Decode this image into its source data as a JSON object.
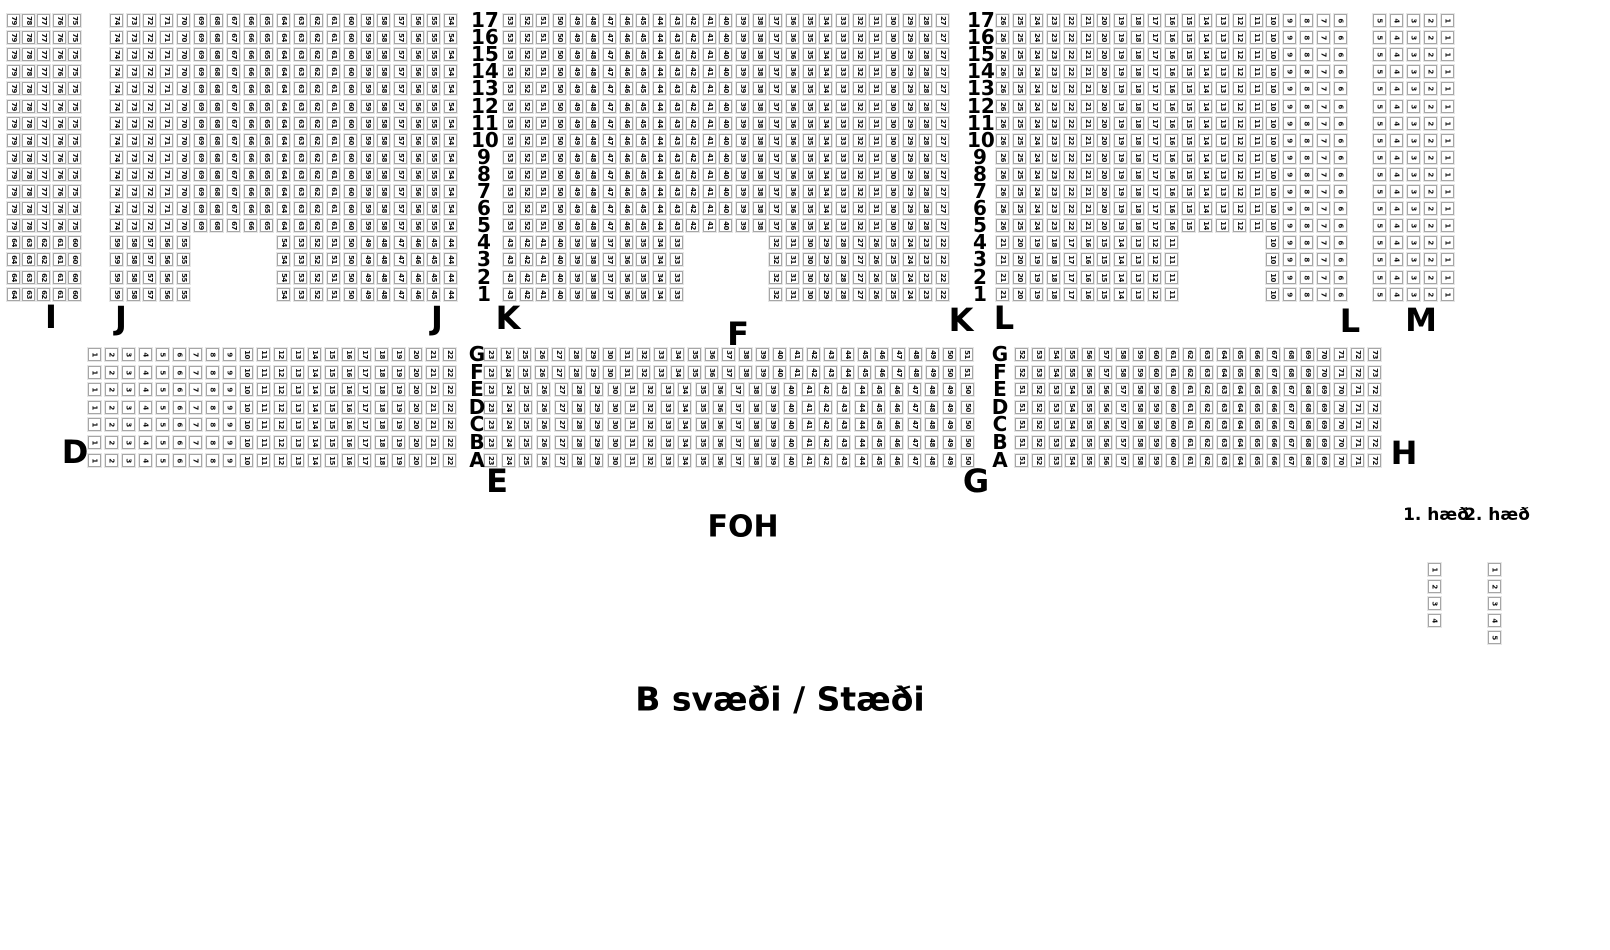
{
  "labels": {
    "section_i": "I",
    "section_j": "J",
    "section_k": "K",
    "section_l": "L",
    "section_m": "M",
    "section_d": "D",
    "section_e": "E",
    "section_f": "F",
    "section_g": "G",
    "section_h": "H",
    "foh": "FOH",
    "area_title": "B svæði / Stæði",
    "floor_1": "1. hæð",
    "floor_2": "2. hæð"
  },
  "colors": {
    "background": "#ffffff",
    "seat_fill": "#ffffff",
    "seat_border": "#a6a6a6",
    "text": "#000000"
  },
  "seatmap": {
    "seat_size": 13,
    "blocks": [
      {
        "name": "rear-block",
        "y0": 14,
        "row_pitch": 17.1,
        "row_labels": [
          "17",
          "16",
          "15",
          "14",
          "13",
          "12",
          "11",
          "10",
          "9",
          "8",
          "7",
          "6",
          "5",
          "4",
          "3",
          "2",
          "1"
        ],
        "label_cols": [
          {
            "x": 471
          },
          {
            "x": 967
          }
        ],
        "sections": [
          {
            "name": "I",
            "x": 7,
            "pitch": 15.2,
            "groups": [
              {
                "rows": [
                  0,
                  12
                ],
                "runs": [
                  {
                    "c0": 0,
                    "from": 79,
                    "to": 75
                  }
                ]
              },
              {
                "rows": [
                  13,
                  16
                ],
                "runs": [
                  {
                    "c0": 0,
                    "from": 64,
                    "to": 60
                  }
                ]
              }
            ]
          },
          {
            "name": "J",
            "x": 110,
            "pitch": 16.7,
            "groups": [
              {
                "rows": [
                  0,
                  12
                ],
                "runs": [
                  {
                    "c0": 0,
                    "from": 74,
                    "to": 54
                  }
                ]
              },
              {
                "rows": [
                  13,
                  16
                ],
                "runs": [
                  {
                    "c0": 0,
                    "from": 59,
                    "to": 55
                  },
                  {
                    "c0": 10,
                    "from": 54,
                    "to": 44
                  }
                ]
              }
            ]
          },
          {
            "name": "K-F-K",
            "x": 503,
            "pitch": 16.65,
            "groups": [
              {
                "rows": [
                  0,
                  12
                ],
                "runs": [
                  {
                    "c0": 0,
                    "from": 53,
                    "to": 27
                  }
                ]
              },
              {
                "rows": [
                  13,
                  16
                ],
                "runs": [
                  {
                    "c0": 0,
                    "from": 43,
                    "to": 33
                  },
                  {
                    "c0": 16,
                    "from": 32,
                    "to": 22
                  }
                ]
              }
            ]
          },
          {
            "name": "L",
            "x": 996,
            "pitch": 16.9,
            "groups": [
              {
                "rows": [
                  0,
                  12
                ],
                "runs": [
                  {
                    "c0": 0,
                    "from": 26,
                    "to": 6
                  }
                ]
              },
              {
                "rows": [
                  13,
                  16
                ],
                "runs": [
                  {
                    "c0": 0,
                    "from": 21,
                    "to": 11
                  },
                  {
                    "c0": 16,
                    "from": 10,
                    "to": 6
                  }
                ]
              }
            ]
          },
          {
            "name": "M",
            "x": 1373,
            "pitch": 17,
            "groups": [
              {
                "rows": [
                  0,
                  16
                ],
                "runs": [
                  {
                    "c0": 0,
                    "from": 5,
                    "to": 1
                  }
                ]
              }
            ]
          }
        ]
      },
      {
        "name": "front-block",
        "y0": 348,
        "row_pitch": 17.6,
        "row_labels": [
          "G",
          "F",
          "E",
          "D",
          "C",
          "B",
          "A"
        ],
        "label_cols": [
          {
            "x": 464
          },
          {
            "x": 987
          }
        ],
        "sections": [
          {
            "name": "D",
            "x": 88,
            "pitch": 16.9,
            "groups": [
              {
                "rows": [
                  0,
                  6
                ],
                "runs": [
                  {
                    "c0": 0,
                    "from": 1,
                    "to": 22
                  }
                ]
              }
            ]
          },
          {
            "name": "E-F-G",
            "x": 484,
            "pitch": 17,
            "groups": [
              {
                "rows": [
                  0,
                  1
                ],
                "pitch": 17.0,
                "runs": [
                  {
                    "c0": 0,
                    "from": 23,
                    "to": 51
                  }
                ]
              },
              {
                "rows": [
                  2,
                  6
                ],
                "pitch": 17.65,
                "runs": [
                  {
                    "c0": 0,
                    "from": 23,
                    "to": 50
                  }
                ]
              }
            ]
          },
          {
            "name": "H",
            "x": 1015,
            "pitch": 16.8,
            "groups": [
              {
                "rows": [
                  0,
                  1
                ],
                "runs": [
                  {
                    "c0": 0,
                    "from": 52,
                    "to": 73
                  }
                ]
              },
              {
                "rows": [
                  2,
                  6
                ],
                "runs": [
                  {
                    "c0": 0,
                    "from": 51,
                    "to": 72
                  }
                ]
              }
            ]
          }
        ]
      }
    ],
    "floor_columns": [
      {
        "name": "floor-1-column",
        "x": 1428,
        "y0": 563,
        "pitch": 17,
        "seats": [
          1,
          2,
          3,
          4
        ]
      },
      {
        "name": "floor-2-column",
        "x": 1488,
        "y0": 563,
        "pitch": 17,
        "seats": [
          1,
          2,
          3,
          4,
          5
        ]
      }
    ]
  }
}
